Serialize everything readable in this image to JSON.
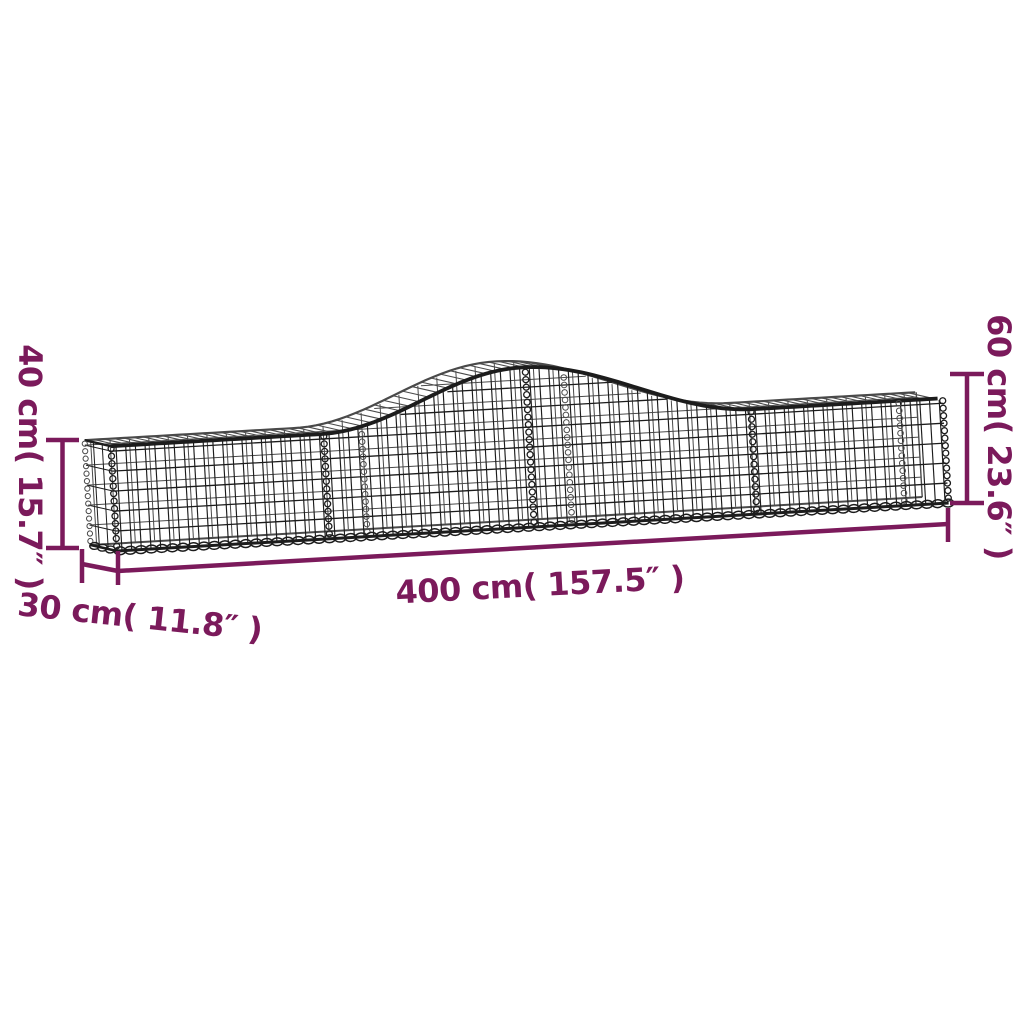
{
  "page": {
    "background": "#ffffff"
  },
  "colors": {
    "accent": "#7B1A5B",
    "wire_front": "#1C1C1C",
    "wire_back": "#4A4A4A"
  },
  "labels": {
    "peak_height": "60 cm( 23.6″ )",
    "end_height": "40 cm( 15.7″ )",
    "length": "400 cm( 157.5″ )",
    "depth": "30 cm( 11.8″ )"
  },
  "values": {
    "peak_height_cm": 60,
    "peak_height_in": 23.6,
    "end_height_cm": 40,
    "end_height_in": 15.7,
    "length_cm": 400,
    "length_in": 157.5,
    "depth_cm": 30,
    "depth_in": 11.8
  }
}
